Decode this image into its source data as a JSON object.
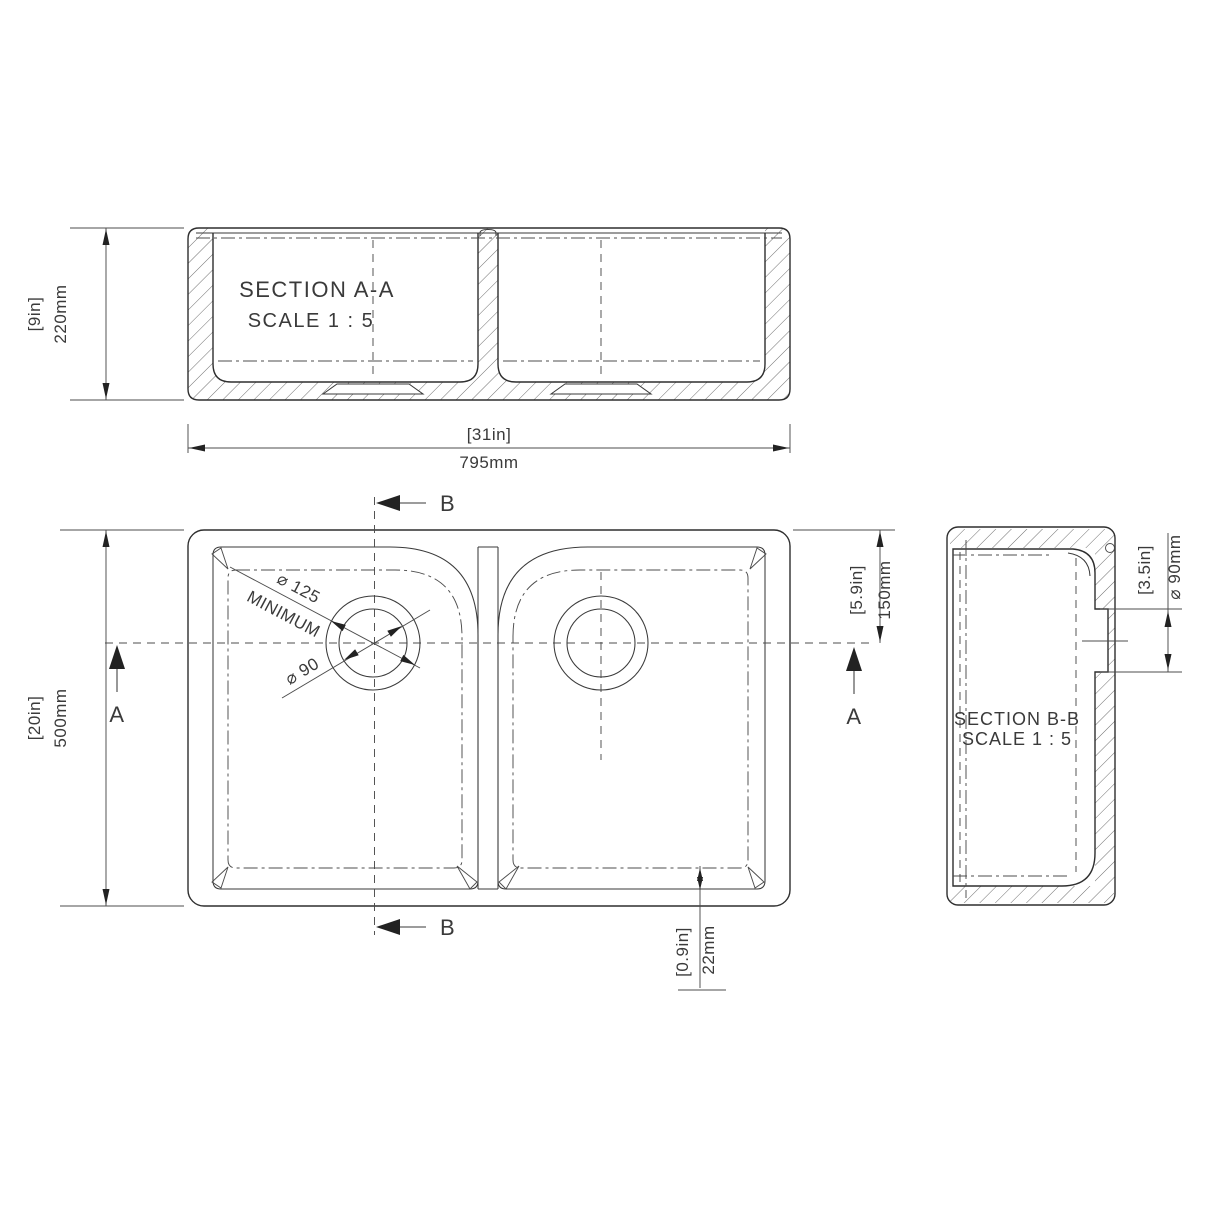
{
  "drawing": {
    "section_aa": {
      "title": "SECTION A-A",
      "scale": "SCALE  1 : 5"
    },
    "section_bb": {
      "title": "SECTION B-B",
      "scale": "SCALE 1 : 5"
    },
    "markers": {
      "a": "A",
      "b": "B"
    },
    "dims": {
      "bowl_height": {
        "imperial": "[9in]",
        "metric": "220mm"
      },
      "overall_width": {
        "imperial": "[31in]",
        "metric": "795mm"
      },
      "overall_depth": {
        "imperial": "[20in]",
        "metric": "500mm"
      },
      "drain_center_offset": {
        "imperial": "[5.9in]",
        "metric": "150mm"
      },
      "wall_thickness": {
        "imperial": "[0.9in]",
        "metric": "22mm"
      },
      "drain_hole_bb": {
        "imperial": "[3.5in]",
        "metric": "⌀ 90mm"
      },
      "waste_clearance": {
        "label": "⌀ 125",
        "note": "MINIMUM"
      },
      "drain_hole_plan": {
        "label": "⌀ 90"
      }
    }
  }
}
